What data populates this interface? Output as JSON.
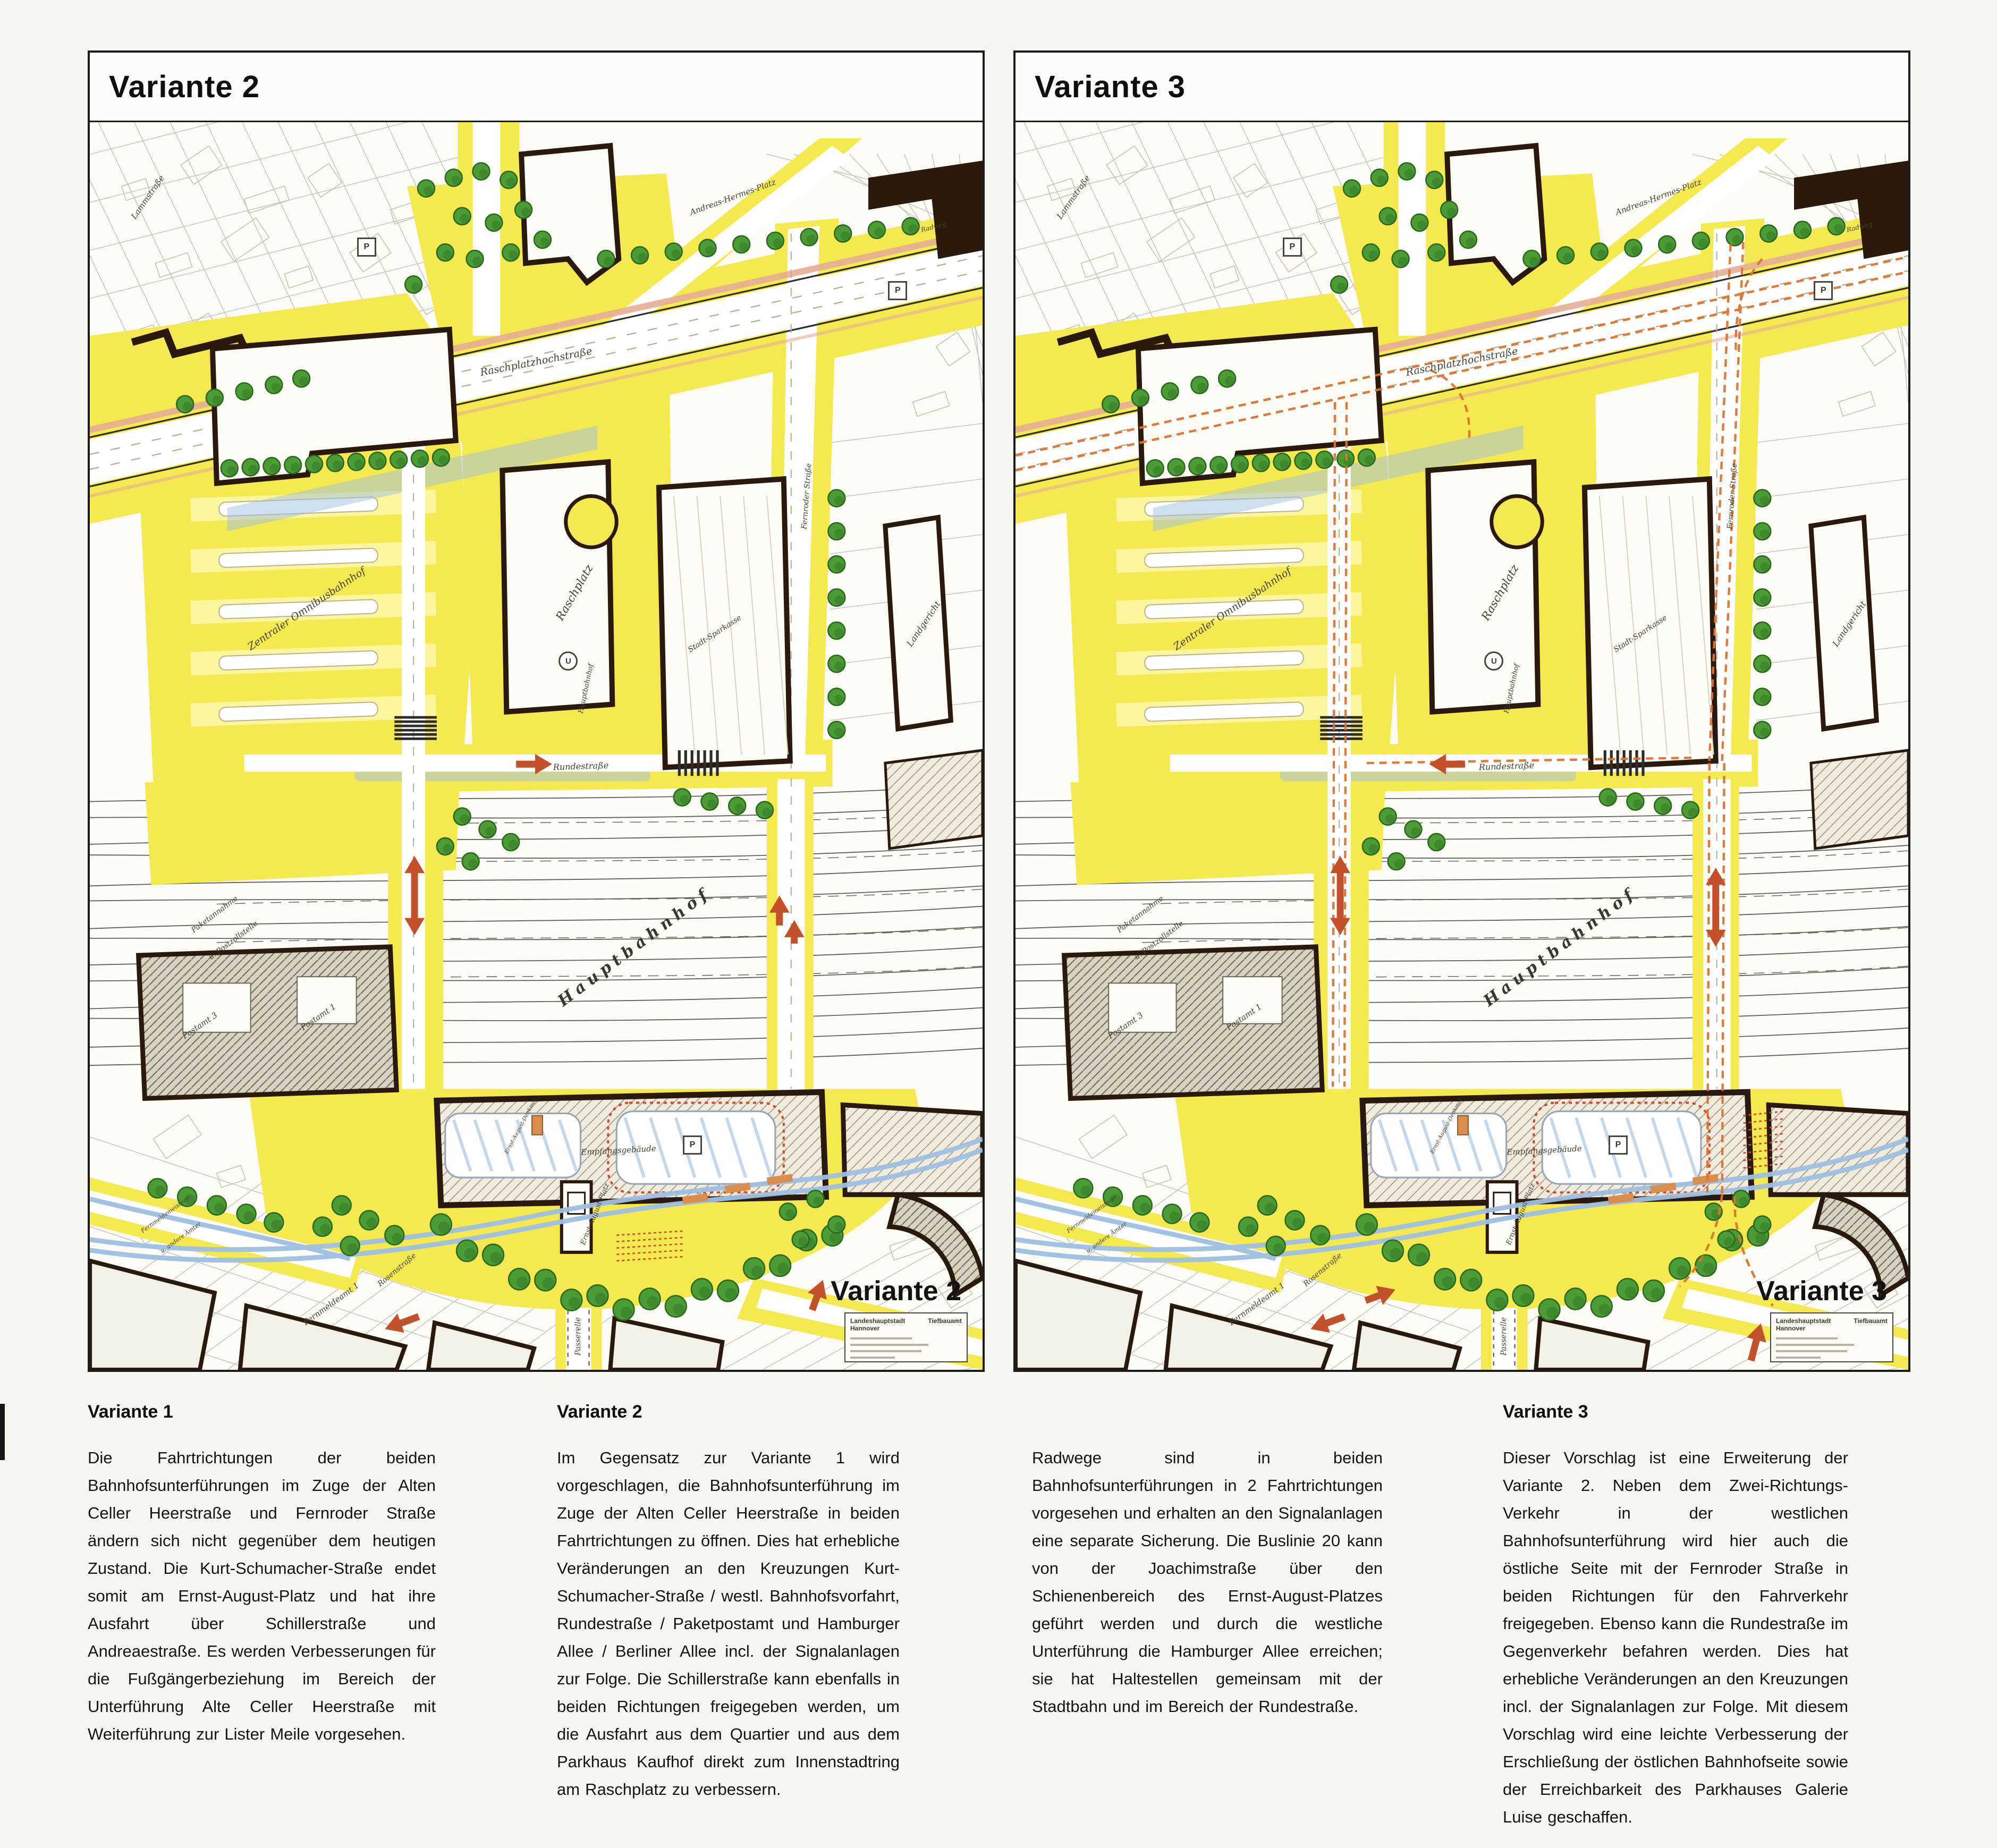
{
  "panels": [
    {
      "title": "Variante 2",
      "corner_label": "Variante 2"
    },
    {
      "title": "Variante 3",
      "corner_label": "Variante 3"
    }
  ],
  "legend": {
    "title_left": "Landeshauptstadt Hannover",
    "title_right": "Tiefbauamt"
  },
  "map_labels": [
    {
      "t": "Lammstraße",
      "x": 6.5,
      "y": 6.0,
      "r": -55,
      "s": 15
    },
    {
      "t": "Andreas-Hermes-Platz",
      "x": 72.0,
      "y": 6.0,
      "r": -20,
      "s": 15
    },
    {
      "t": "Radweg",
      "x": 94.5,
      "y": 8.4,
      "r": -14,
      "s": 12
    },
    {
      "t": "Raschplatzhochstraße",
      "x": 50.0,
      "y": 19.2,
      "r": -11,
      "s": 19
    },
    {
      "t": "Zentraler Omnibusbahnhof",
      "x": 24.3,
      "y": 39.0,
      "r": -34,
      "s": 19
    },
    {
      "t": "Raschplatz",
      "x": 54.3,
      "y": 37.7,
      "r": -60,
      "s": 21
    },
    {
      "t": "U",
      "x": 53.6,
      "y": 43.2,
      "r": 0,
      "s": 15,
      "k": "usym"
    },
    {
      "t": "Hauptbahnhof",
      "x": 55.6,
      "y": 45.4,
      "r": -78,
      "s": 13
    },
    {
      "t": "Stadt-Sparkasse",
      "x": 70.0,
      "y": 41.0,
      "r": -33,
      "s": 14
    },
    {
      "t": "Landgericht",
      "x": 93.4,
      "y": 40.2,
      "r": -56,
      "s": 16
    },
    {
      "t": "Fernroder Straße",
      "x": 80.3,
      "y": 30.0,
      "r": -86,
      "s": 14
    },
    {
      "t": "Rundestraße",
      "x": 55.0,
      "y": 51.6,
      "r": -2,
      "s": 16
    },
    {
      "t": "Paketannahme",
      "x": 14.0,
      "y": 63.5,
      "r": -37,
      "s": 14
    },
    {
      "t": "u. Postzollstelle",
      "x": 16.1,
      "y": 65.6,
      "r": -37,
      "s": 14
    },
    {
      "t": "Hauptbahnhof",
      "x": 61.0,
      "y": 66.1,
      "r": -37,
      "s": 30,
      "k": "big"
    },
    {
      "t": "Postamt 3",
      "x": 12.3,
      "y": 72.4,
      "r": -34,
      "s": 15
    },
    {
      "t": "Postamt 1",
      "x": 25.6,
      "y": 71.7,
      "r": -34,
      "s": 15
    },
    {
      "t": "Empfangsgebäude",
      "x": 59.2,
      "y": 82.4,
      "r": -3,
      "s": 15
    },
    {
      "t": "Ernst-August-Denkmal",
      "x": 48.3,
      "y": 80.5,
      "r": -62,
      "s": 10
    },
    {
      "t": "Ernst-August-Platz",
      "x": 56.6,
      "y": 87.5,
      "r": -68,
      "s": 13
    },
    {
      "t": "Fernmeldemeisterei",
      "x": 8.5,
      "y": 87.5,
      "r": -36,
      "s": 11
    },
    {
      "t": "u. andere Ämter",
      "x": 10.2,
      "y": 89.4,
      "r": -36,
      "s": 11
    },
    {
      "t": "Rosenstraße",
      "x": 34.4,
      "y": 92.0,
      "r": -40,
      "s": 14
    },
    {
      "t": "Fernmeldeamt 1",
      "x": 27.0,
      "y": 94.7,
      "r": -36,
      "s": 15
    },
    {
      "t": "Passerelle",
      "x": 54.7,
      "y": 97.3,
      "r": -90,
      "s": 14
    },
    {
      "t": "P",
      "x": 31.0,
      "y": 10.0,
      "r": 0,
      "s": 16,
      "k": "sym"
    },
    {
      "t": "P",
      "x": 90.5,
      "y": 13.5,
      "r": 0,
      "s": 16,
      "k": "sym"
    },
    {
      "t": "P",
      "x": 67.5,
      "y": 82.0,
      "r": 0,
      "s": 16,
      "k": "sym"
    }
  ],
  "columns": [
    {
      "heading": "Variante 1",
      "body": "Die Fahrtrichtungen der beiden Bahnhofsunterführungen im Zuge der Alten Celler Heerstraße und Fernroder Straße ändern sich nicht gegenüber dem heutigen Zustand. Die Kurt-Schumacher-Straße endet somit am Ernst-August-Platz und hat ihre Ausfahrt über Schillerstraße und Andreaestraße. Es werden Verbesserungen für die Fußgängerbeziehung im Bereich der Unterführung Alte Celler Heerstraße mit Weiterführung zur Lister Meile vorgesehen."
    },
    {
      "heading": "Variante 2",
      "body": "Im Gegensatz zur Variante 1 wird vorgeschlagen, die Bahnhofsunterführung im Zuge der Alten Celler Heerstraße in beiden Fahrtrichtungen zu öffnen. Dies hat erhebliche Veränderungen an den Kreuzungen Kurt-Schumacher-Straße / westl. Bahnhofsvorfahrt, Rundestraße / Paketpostamt und Hamburger Allee / Berliner Allee incl. der Signalanlagen zur Folge. Die Schillerstraße kann ebenfalls in beiden Richtungen freigegeben werden, um die Ausfahrt aus dem Quartier und aus dem Parkhaus Kaufhof direkt zum Innenstadtring am Raschplatz zu verbessern."
    },
    {
      "heading": "",
      "body": "Radwege sind in beiden Bahnhofsunterführungen in 2 Fahrtrichtungen vorgesehen und erhalten an den Signalanlagen eine separate Sicherung. Die Buslinie 20 kann von der Joachimstraße über den Schienenbereich des Ernst-August-Platzes geführt werden und durch die westliche Unterführung die Hamburger Allee erreichen; sie hat Haltestellen gemeinsam mit der Stadtbahn und im Bereich der Rundestraße."
    },
    {
      "heading": "Variante 3",
      "body": "Dieser Vorschlag ist eine Erweiterung der Variante 2. Neben dem Zwei-Richtungs-Verkehr in der westlichen Bahnhofsunterführung wird hier auch die östliche Seite mit der Fernroder Straße in beiden Richtungen für den Fahrverkehr freigegeben. Ebenso kann die Rundestraße im Gegenverkehr befahren werden. Dies hat erhebliche Veränderungen an den Kreuzungen incl. der Signalanlagen zur Folge. Mit diesem Vorschlag wird eine leichte Verbesserung der Erschließung der östlichen Bahnhofseite sowie der Erreichbarkeit des Parkhauses Galerie Luise geschaffen."
    }
  ],
  "colors": {
    "street_yellow": "#f4e94e",
    "stripe_yellow": "#fbf59d",
    "building_dark": "#2a190d",
    "tree_green": "#4c9c36",
    "tree_dark": "#2c681f",
    "arrow_red": "#c2502b",
    "route_dash_orange": "#dd7330",
    "tram_blue": "#9fbfe2",
    "edge_pink": "#e5ad97",
    "cadastre_gray": "#a29d90",
    "rail_gray": "#514d45"
  }
}
